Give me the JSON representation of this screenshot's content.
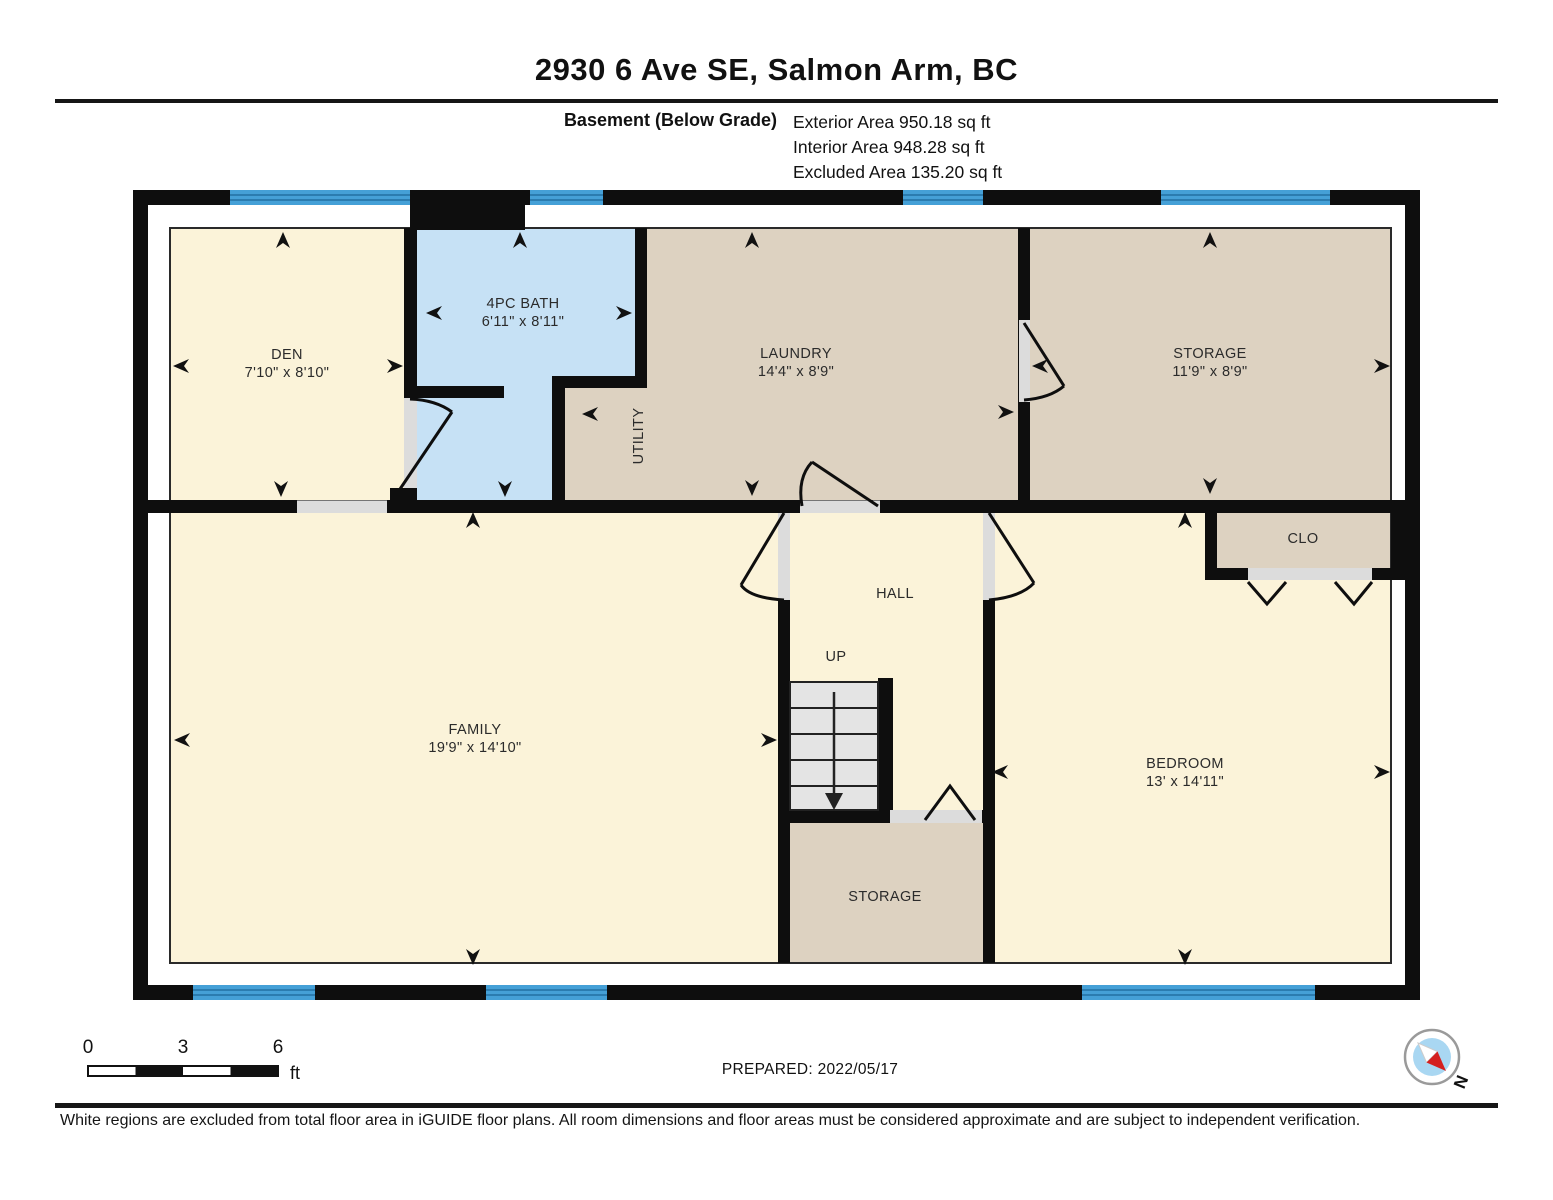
{
  "header": {
    "title": "2930 6 Ave SE, Salmon Arm, BC",
    "floor_label": "Basement (Below Grade)",
    "areas": [
      {
        "label": "Exterior Area 950.18 sq ft"
      },
      {
        "label": "Interior Area 948.28 sq ft"
      },
      {
        "label": "Excluded Area 135.20 sq ft"
      }
    ]
  },
  "floorplan": {
    "rooms": [
      {
        "name": "DEN",
        "dims": "7'10\" x 8'10\""
      },
      {
        "name": "4PC BATH",
        "dims": "6'11\" x 8'11\""
      },
      {
        "name": "LAUNDRY",
        "dims": "14'4\" x 8'9\""
      },
      {
        "name": "UTILITY",
        "dims": ""
      },
      {
        "name": "STORAGE",
        "dims": "11'9\" x 8'9\""
      },
      {
        "name": "HALL",
        "dims": ""
      },
      {
        "name": "FAMILY",
        "dims": "19'9\" x 14'10\""
      },
      {
        "name": "BEDROOM",
        "dims": "13' x 14'11\""
      },
      {
        "name": "STORAGE",
        "dims": ""
      },
      {
        "name": "CLO",
        "dims": ""
      }
    ],
    "stairs_label": "UP",
    "colors": {
      "cream": "#fbf3d9",
      "tan": "#ddd2c1",
      "bath_blue": "#c6e1f5",
      "window_blue": "#45a0d7",
      "wall": "#0e0e0e"
    }
  },
  "footer": {
    "scale": {
      "ticks": [
        "0",
        "3",
        "6"
      ],
      "unit": "ft"
    },
    "prepared": "PREPARED: 2022/05/17",
    "compass_label": "N",
    "disclaimer": "White regions are excluded from total floor area in iGUIDE floor plans. All room dimensions and floor areas must be considered approximate and are subject to independent verification."
  }
}
